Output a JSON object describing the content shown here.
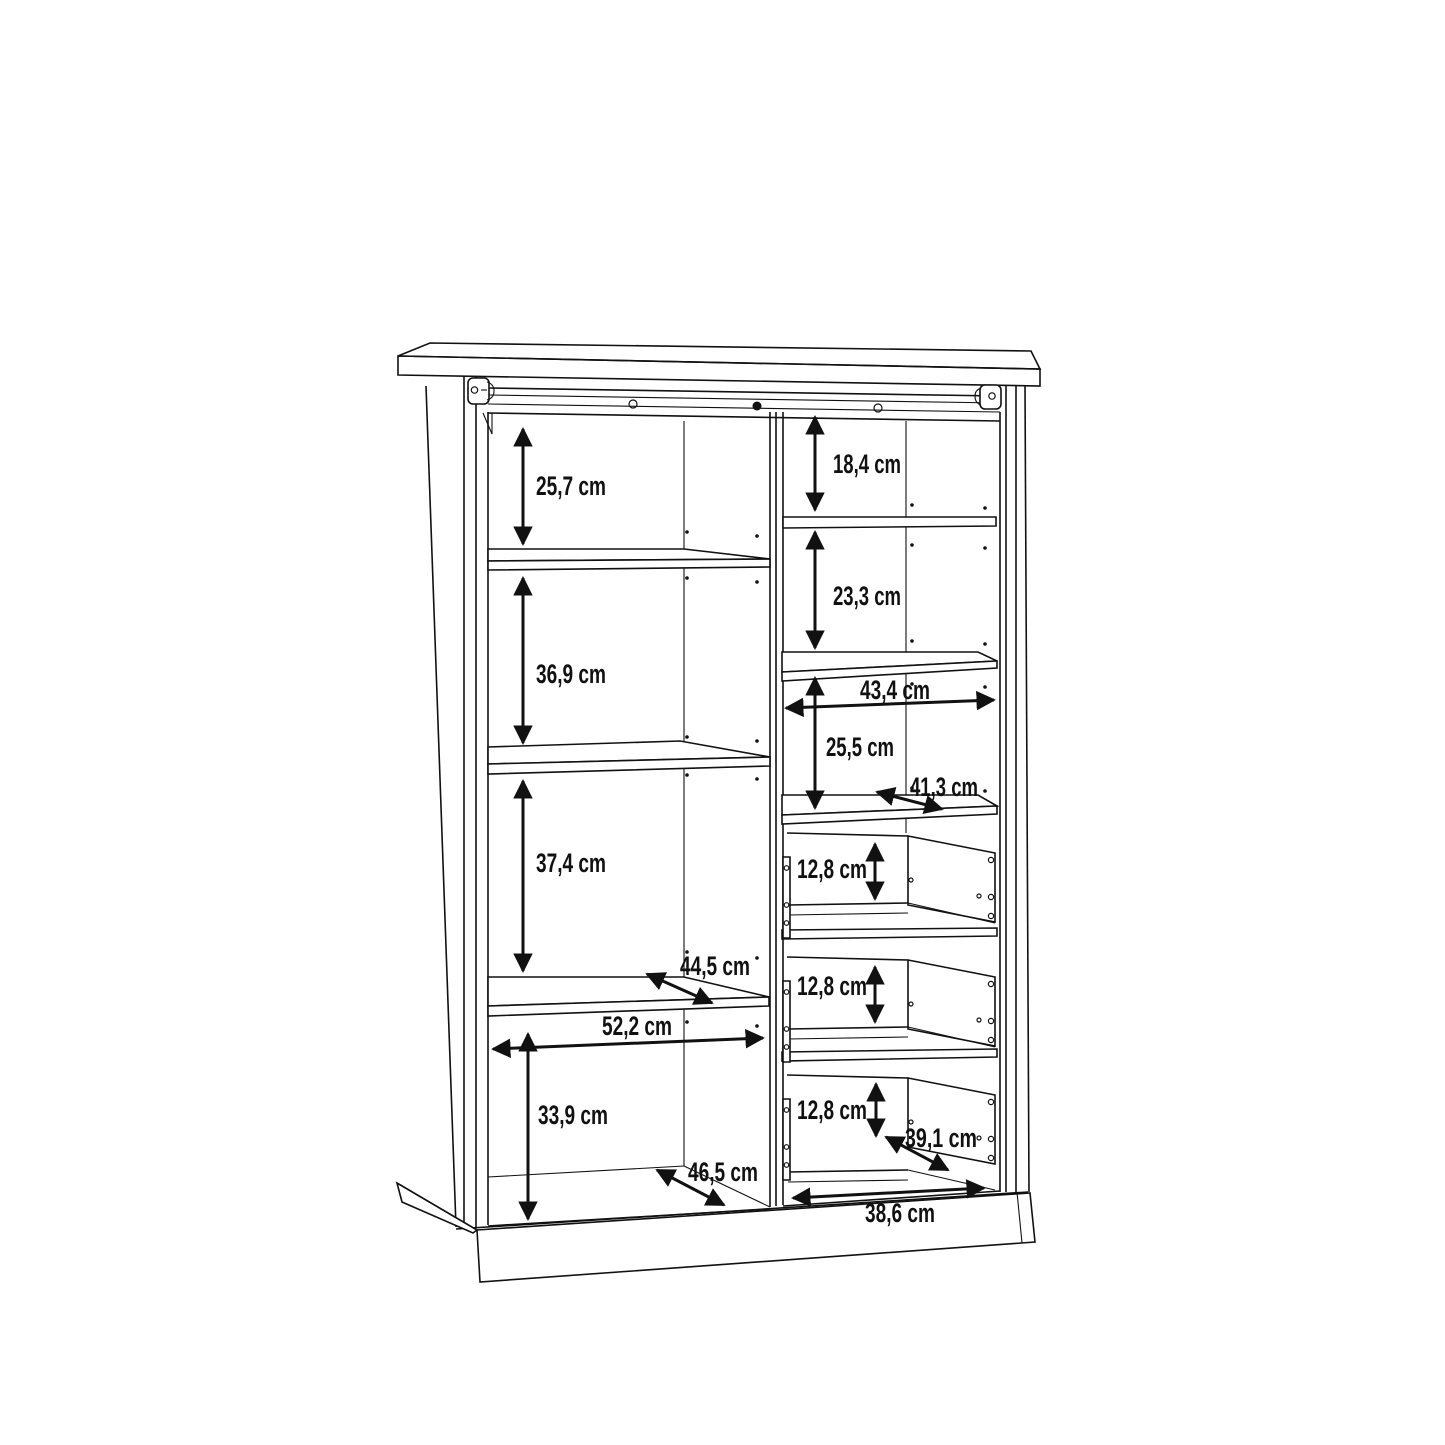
{
  "drawing": {
    "kind": "cabinet interior dimension drawing",
    "unit": "cm",
    "background_color": "#ffffff",
    "line_color": "#111111"
  },
  "left_column": {
    "height_top_to_shelf1": "25,7 cm",
    "height_shelf1_to_shelf2": "36,9 cm",
    "height_shelf2_to_shelf3": "37,4 cm",
    "shelf_depth": "44,5 cm",
    "inner_width": "52,2 cm",
    "height_shelf3_to_bottom": "33,9 cm",
    "bottom_depth": "46,5 cm"
  },
  "right_column": {
    "height_top_to_shelf1": "18,4 cm",
    "height_shelf1_to_shelf2": "23,3 cm",
    "inner_width": "43,4 cm",
    "height_shelf2_to_shelf3": "25,5 cm",
    "shelf_depth": "41,3 cm",
    "drawer1_height": "12,8 cm",
    "drawer2_height": "12,8 cm",
    "drawer3_height": "12,8 cm",
    "drawer_depth": "39,1 cm",
    "bottom_inner_width": "38,6 cm"
  }
}
